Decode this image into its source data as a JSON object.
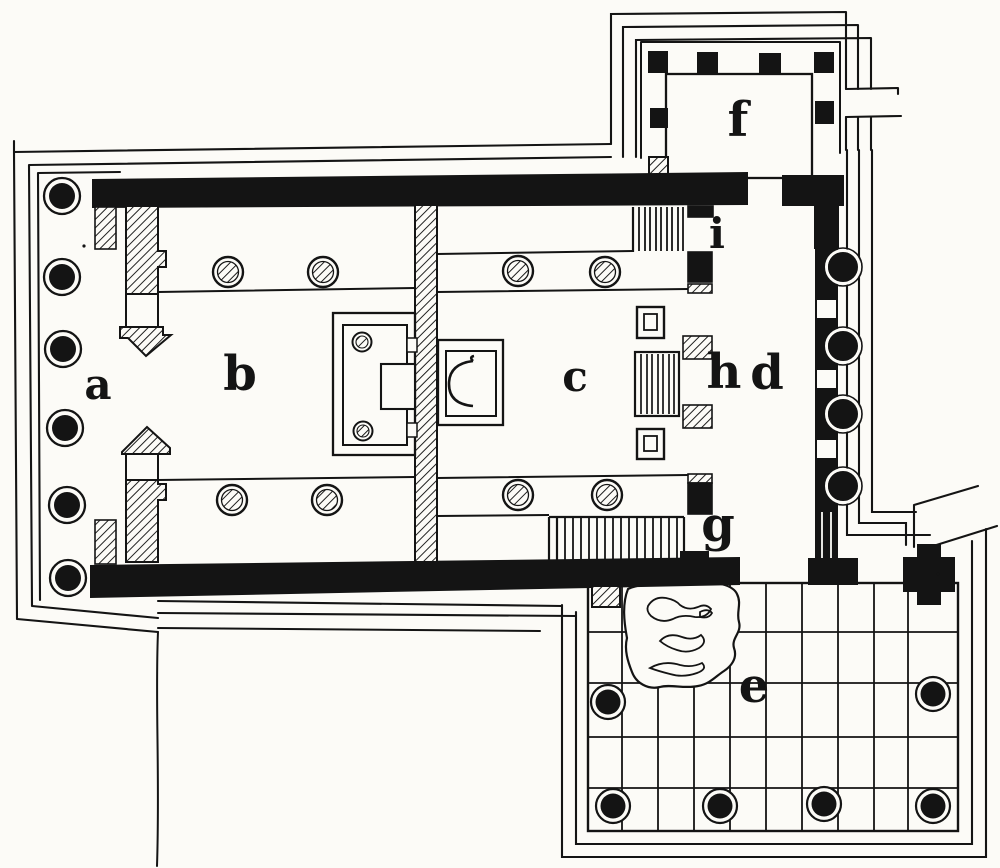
{
  "figure": {
    "kind": "engraved-architectural-floor-plan",
    "ink": "#141414",
    "paper": "#fcfbf7",
    "room_labels": {
      "a": "a",
      "b": "b",
      "c": "c",
      "d": "d",
      "e": "e",
      "f": "f",
      "g": "g",
      "h": "h",
      "i": "i"
    }
  }
}
